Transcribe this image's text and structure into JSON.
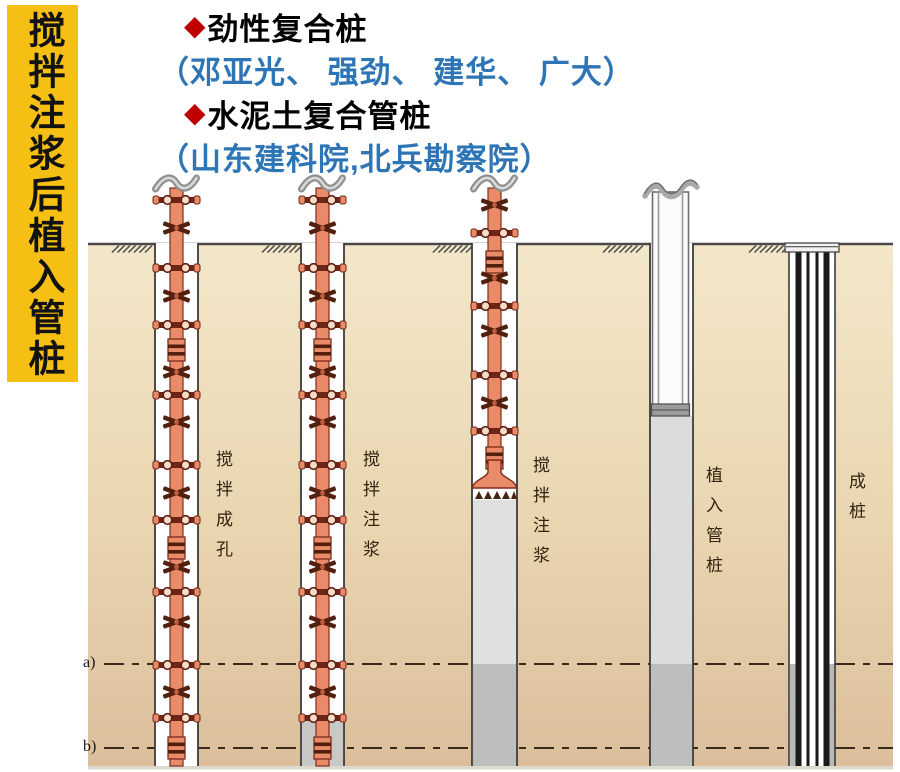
{
  "banner": {
    "text": "搅拌注浆后植入管桩"
  },
  "header": {
    "items": [
      {
        "bullet": "◆",
        "title": "劲性复合桩",
        "subtitle": "（邓亚光、 强劲、 建华、 广大）"
      },
      {
        "bullet": "◆",
        "title": "水泥土复合管桩",
        "subtitle": "（山东建科院,北兵勘察院）"
      }
    ]
  },
  "diagram": {
    "stage_labels": [
      "搅拌成孔",
      "搅拌注浆",
      "搅拌注浆",
      "植入管桩",
      "成桩"
    ],
    "depth_markers": [
      "a)",
      "b)"
    ]
  },
  "colors": {
    "banner_bg": "#F5C013",
    "bullet_red": "#C00000",
    "title_black": "#000000",
    "subtitle_blue": "#2E75B6",
    "soil_top": "#F3E7C9",
    "soil_bottom": "#DCBE9B",
    "drill_shaft_orange": "#E98A69",
    "drill_detail_dark": "#6E2516",
    "grout_light": "#DFDFDD",
    "grout_dark": "#BEBEBC",
    "ground_line": "#4A4A4A"
  }
}
